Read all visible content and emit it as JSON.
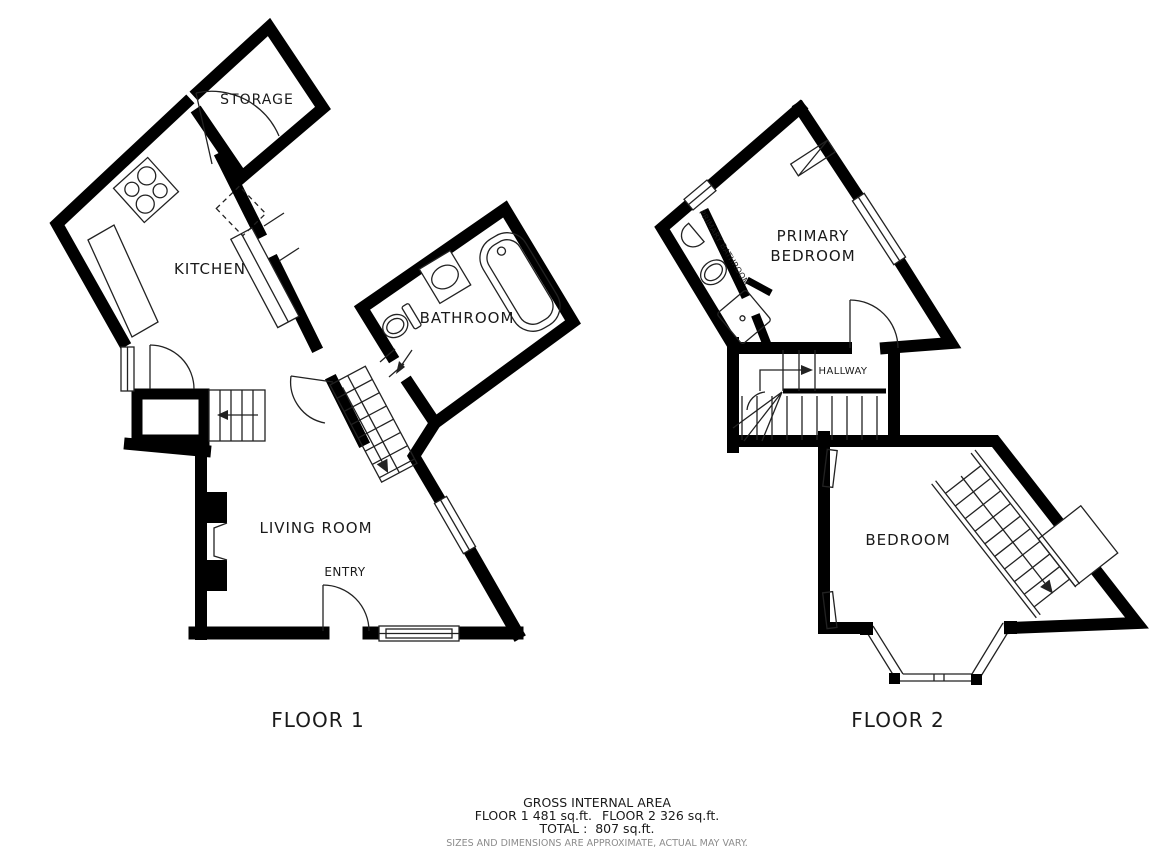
{
  "page": {
    "background_color": "#ffffff",
    "wall_color": "#000000",
    "line_color": "#222222"
  },
  "floor1": {
    "title": "FLOOR 1",
    "rooms": {
      "storage": "STORAGE",
      "kitchen": "KITCHEN",
      "bathroom": "BATHROOM",
      "living_room": "LIVING ROOM",
      "entry": "ENTRY"
    }
  },
  "floor2": {
    "title": "FLOOR 2",
    "rooms": {
      "primary_bedroom_line1": "PRIMARY",
      "primary_bedroom_line2": "BEDROOM",
      "primary_bathroom": "PRIMARY BATHROOM",
      "hallway": "HALLWAY",
      "bedroom": "BEDROOM"
    }
  },
  "footer": {
    "heading": "GROSS INTERNAL AREA",
    "floor1_area": "FLOOR 1 481 sq.ft.",
    "floor2_area": "FLOOR 2 326 sq.ft.",
    "total": "TOTAL :  807 sq.ft.",
    "disclaimer": "SIZES AND DIMENSIONS ARE APPROXIMATE, ACTUAL MAY VARY.",
    "disclaimer_color": "#8c8c8c"
  },
  "areas": {
    "floor1_sqft": 481,
    "floor2_sqft": 326,
    "total_sqft": 807
  }
}
